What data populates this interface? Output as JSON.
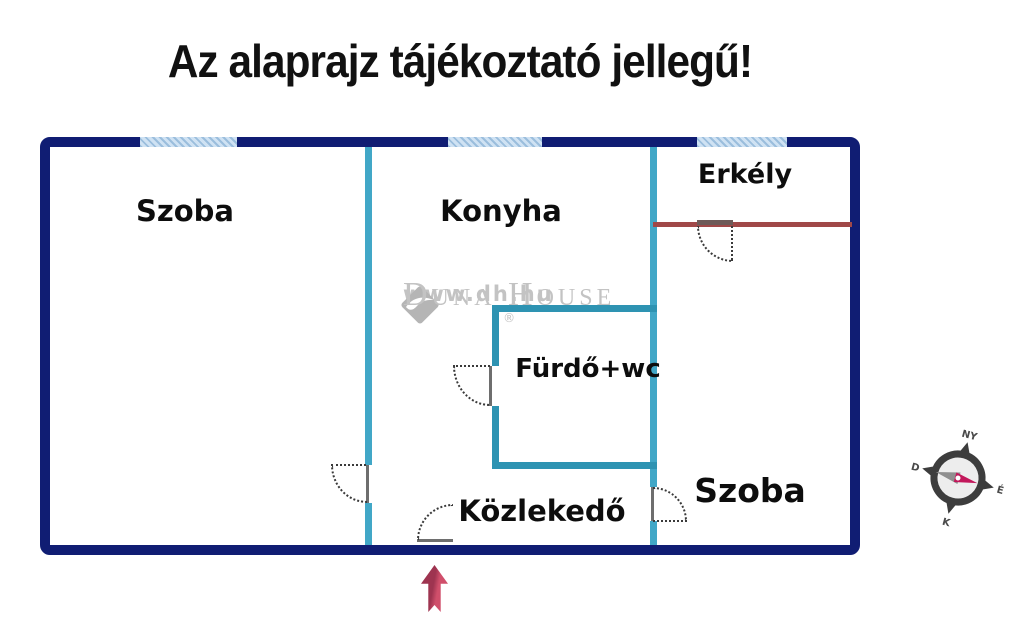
{
  "title": "Az alaprajz tájékoztató jellegű!",
  "floorplan": {
    "rooms": [
      {
        "name": "szoba-left",
        "label": "Szoba"
      },
      {
        "name": "konyha",
        "label": "Konyha"
      },
      {
        "name": "erkely",
        "label": "Erkély"
      },
      {
        "name": "furdo-wc",
        "label": "Fürdő+wc"
      },
      {
        "name": "kozlekedo",
        "label": "Közlekedő"
      },
      {
        "name": "szoba-right",
        "label": "Szoba"
      }
    ]
  },
  "watermark": {
    "brand": "Duna House",
    "registered": "®",
    "url": "www.dh.hu"
  },
  "compass": {
    "west": "NY",
    "north": "É",
    "east": "K",
    "south": "D"
  },
  "colors": {
    "outer_wall": "#101d73",
    "interior_wall": "#41a7c7",
    "bathroom_wall": "#2e93b2",
    "window_fill": "#cfe2f3",
    "balcony_rail": "#a04848",
    "entrance_arrow": "#c24661",
    "watermark_gray": "#c3c3c3",
    "title_text": "#111111"
  }
}
